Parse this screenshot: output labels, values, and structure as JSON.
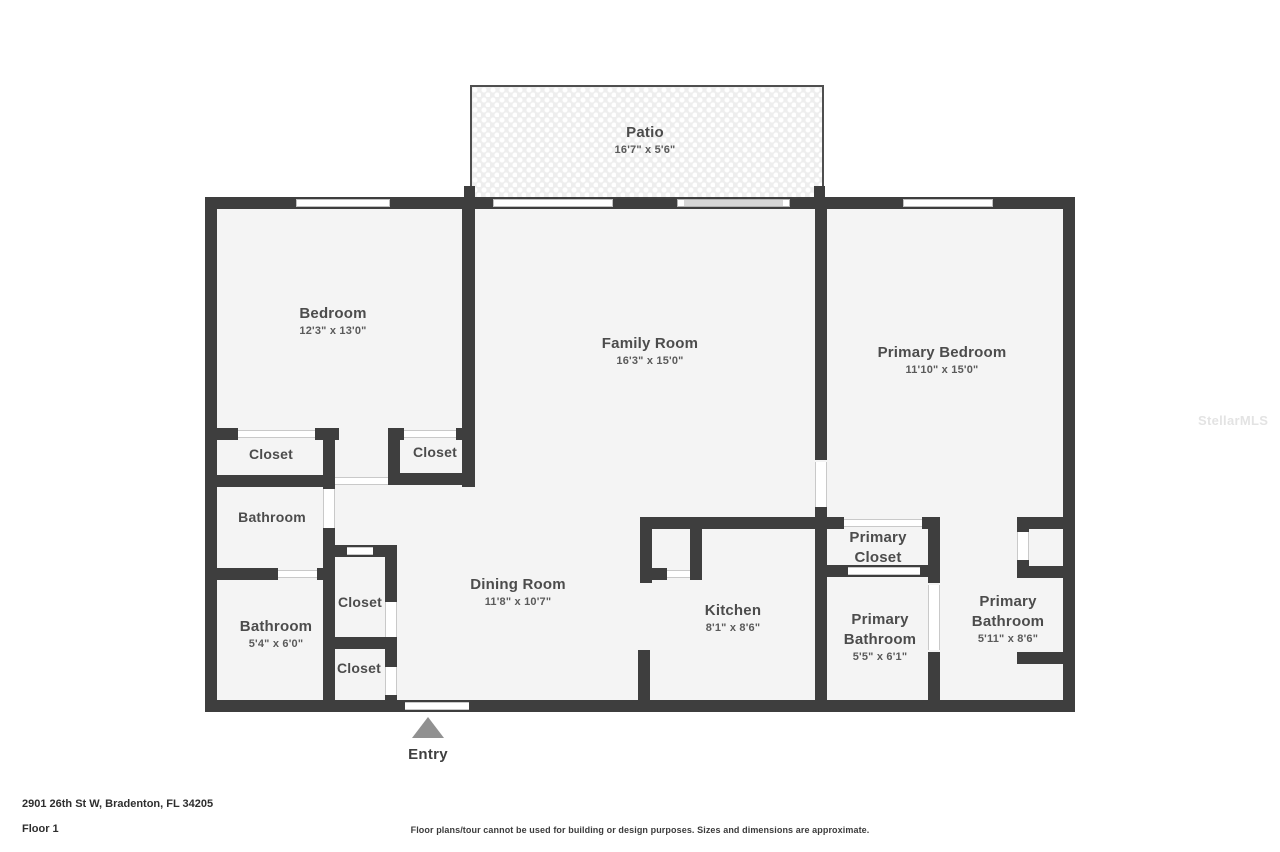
{
  "rooms": {
    "patio": {
      "name": "Patio",
      "dims": "16'7\" x 5'6\""
    },
    "bedroom": {
      "name": "Bedroom",
      "dims": "12'3\" x 13'0\""
    },
    "family_room": {
      "name": "Family Room",
      "dims": "16'3\" x 15'0\""
    },
    "primary_bedroom": {
      "name": "Primary Bedroom",
      "dims": "11'10\" x 15'0\""
    },
    "closet_a": {
      "name": "Closet"
    },
    "closet_b": {
      "name": "Closet"
    },
    "bathroom_hall": {
      "name": "Bathroom"
    },
    "bathroom_guest": {
      "name": "Bathroom",
      "dims": "5'4\" x 6'0\""
    },
    "closet_hall_upper": {
      "name": "Closet"
    },
    "closet_hall_lower": {
      "name": "Closet"
    },
    "dining_room": {
      "name": "Dining Room",
      "dims": "11'8\" x 10'7\""
    },
    "kitchen": {
      "name": "Kitchen",
      "dims": "8'1\" x 8'6\""
    },
    "primary_closet": {
      "name": "Primary Closet"
    },
    "primary_bathroom_a": {
      "name": "Primary Bathroom",
      "dims": "5'5\" x 6'1\""
    },
    "primary_bathroom_b": {
      "name": "Primary Bathroom",
      "dims": "5'11\" x 8'6\""
    }
  },
  "entry": {
    "label": "Entry"
  },
  "footer": {
    "address": "2901 26th St W, Bradenton, FL 34205",
    "floor": "Floor 1",
    "disclaimer": "Floor plans/tour cannot be used for building or design purposes. Sizes and dimensions are approximate."
  },
  "watermark": "StellarMLS",
  "colors": {
    "wall": "#3e3e3e",
    "floor": "#f4f4f4",
    "patio_base": "#eeeeee",
    "entry_marker": "#919191"
  }
}
